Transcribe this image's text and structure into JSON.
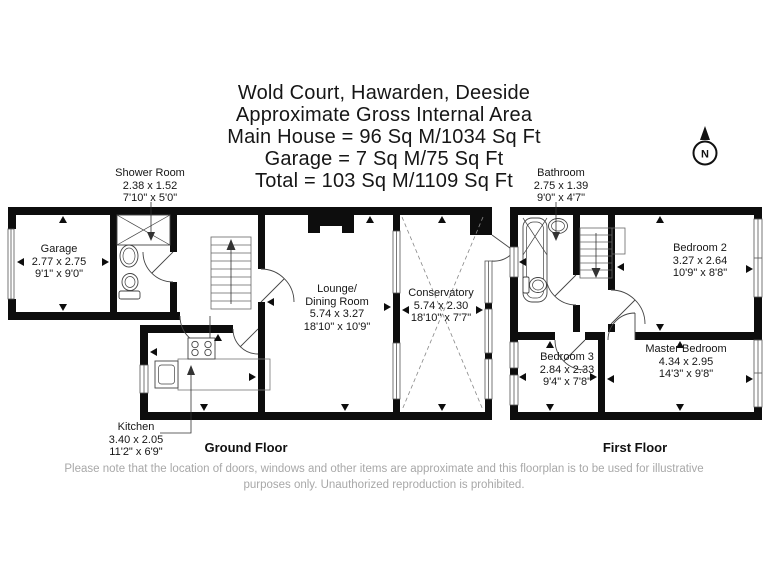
{
  "title": {
    "lines": [
      "Wold Court, Hawarden, Deeside",
      "Approximate Gross Internal Area",
      "Main House = 96 Sq M/1034 Sq Ft",
      "Garage = 7 Sq M/75 Sq Ft",
      "Total = 103 Sq M/1109 Sq Ft"
    ]
  },
  "compass": {
    "label": "N"
  },
  "ground_floor": {
    "label": "Ground Floor",
    "rooms": {
      "garage": {
        "name": "Garage",
        "metric": "2.77 x 2.75",
        "imperial": "9'1\" x 9'0\""
      },
      "shower_room": {
        "name": "Shower Room",
        "metric": "2.38 x 1.52",
        "imperial": "7'10\" x 5'0\""
      },
      "lounge_dining": {
        "name_line1": "Lounge/",
        "name_line2": "Dining Room",
        "metric": "5.74 x 3.27",
        "imperial": "18'10\" x 10'9\""
      },
      "conservatory": {
        "name": "Conservatory",
        "metric": "5.74 x 2.30",
        "imperial": "18'10\" x 7'7\""
      },
      "kitchen": {
        "name": "Kitchen",
        "metric": "3.40 x 2.05",
        "imperial": "11'2\" x 6'9\""
      }
    }
  },
  "first_floor": {
    "label": "First Floor",
    "rooms": {
      "bathroom": {
        "name": "Bathroom",
        "metric": "2.75 x 1.39",
        "imperial": "9'0\" x 4'7\""
      },
      "bedroom_2": {
        "name": "Bedroom 2",
        "metric": "3.27 x 2.64",
        "imperial": "10'9\" x 8'8\""
      },
      "bedroom_3": {
        "name": "Bedroom 3",
        "metric": "2.84 x 2.33",
        "imperial": "9'4\" x 7'8\""
      },
      "master_bedroom": {
        "name": "Master Bedroom",
        "metric": "4.34 x 2.95",
        "imperial": "14'3\" x 9'8\""
      }
    }
  },
  "disclaimer": {
    "line1": "Please note that the location of doors, windows and other items are approximate and this floorplan is to be used for illustrative",
    "line2": "purposes only. Unauthorized reproduction is prohibited."
  },
  "colors": {
    "wall": "#0d0d0d",
    "text": "#161616",
    "disclaimer": "#a8a8a8"
  }
}
